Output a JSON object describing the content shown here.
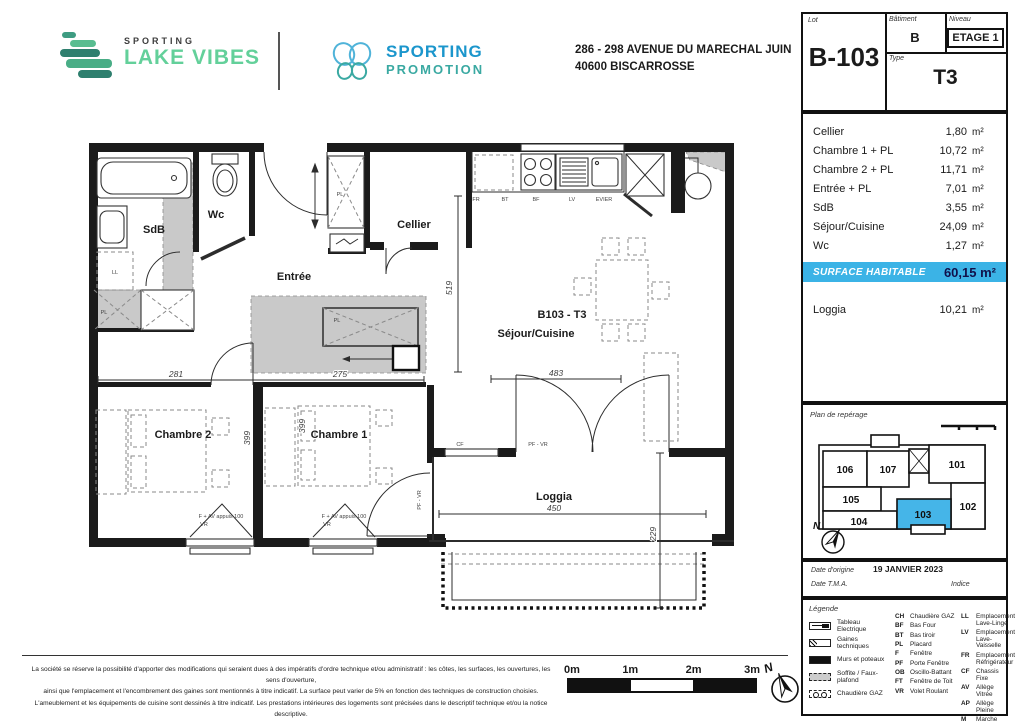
{
  "header": {
    "brand_small": "SPORTING",
    "brand_name": "LAKE VIBES",
    "promo_line1": "SPORTING",
    "promo_line2": "PROMOTION",
    "address_line1": "286 - 298 AVENUE DU MARECHAL JUIN",
    "address_line2": "40600 BISCARROSSE"
  },
  "lot": {
    "lot_label": "Lot",
    "lot_value": "B-103",
    "batiment_label": "Bâtiment",
    "batiment_value": "B",
    "niveau_label": "Niveau",
    "niveau_value": "ETAGE 1",
    "type_label": "Type",
    "type_value": "T3"
  },
  "areas": {
    "rows": [
      {
        "label": "Cellier",
        "value": "1,80",
        "unit": "m²"
      },
      {
        "label": "Chambre 1 + PL",
        "value": "10,72",
        "unit": "m²"
      },
      {
        "label": "Chambre 2 + PL",
        "value": "11,71",
        "unit": "m²"
      },
      {
        "label": "Entrée + PL",
        "value": "7,01",
        "unit": "m²"
      },
      {
        "label": "SdB",
        "value": "3,55",
        "unit": "m²"
      },
      {
        "label": "Séjour/Cuisine",
        "value": "24,09",
        "unit": "m²"
      },
      {
        "label": "Wc",
        "value": "1,27",
        "unit": "m²"
      }
    ],
    "total_label": "SURFACE HABITABLE",
    "total_value": "60,15 m²",
    "loggia": {
      "label": "Loggia",
      "value": "10,21",
      "unit": "m²"
    }
  },
  "reperage": {
    "title": "Plan de repérage",
    "north": "N",
    "units": [
      "106",
      "107",
      "101",
      "105",
      "102",
      "104",
      "103"
    ],
    "highlight_color": "#45b5e8"
  },
  "dates": {
    "origine_label": "Date d'origine",
    "origine_value": "19 JANVIER 2023",
    "tma_label": "Date T.M.A.",
    "indice_label": "Indice"
  },
  "legend": {
    "title": "Légende",
    "icons": [
      {
        "label": "Tableau Electrique"
      },
      {
        "label": "Gaines techniques"
      },
      {
        "label": "Murs et poteaux"
      },
      {
        "label": "Soffite / Faux-plafond"
      },
      {
        "label": "Chaudière GAZ"
      }
    ],
    "abbr1": [
      {
        "code": "CH",
        "label": "Chaudière GAZ"
      },
      {
        "code": "BF",
        "label": "Bas Four"
      },
      {
        "code": "BT",
        "label": "Bas tiroir"
      },
      {
        "code": "PL",
        "label": "Placard"
      },
      {
        "code": "F",
        "label": "Fenêtre"
      },
      {
        "code": "PF",
        "label": "Porte Fenêtre"
      },
      {
        "code": "OB",
        "label": "Oscillo-Battant"
      },
      {
        "code": "FT",
        "label": "Fenêtre de Toit"
      },
      {
        "code": "VR",
        "label": "Volet Roulant"
      }
    ],
    "abbr2": [
      {
        "code": "LL",
        "label": "Emplacement Lave-Linge"
      },
      {
        "code": "LV",
        "label": "Emplacement Lave-Vaisselle"
      },
      {
        "code": "FR",
        "label": "Emplacement Réfrigérateur"
      },
      {
        "code": "CF",
        "label": "Chassis Fixe"
      },
      {
        "code": "AV",
        "label": "Allège Vitrée"
      },
      {
        "code": "AP",
        "label": "Allège Pleine"
      },
      {
        "code": "M",
        "label": "Marche"
      }
    ]
  },
  "plan": {
    "labels": {
      "sdb": "SdB",
      "wc": "Wc",
      "entree": "Entrée",
      "cellier": "Cellier",
      "title": "B103 - T3",
      "subtitle": "Séjour/Cuisine",
      "chambre2": "Chambre 2",
      "chambre1": "Chambre 1",
      "loggia": "Loggia"
    },
    "dims": {
      "d281": "281",
      "d275": "275",
      "d399": "399",
      "d519": "519",
      "d483": "483",
      "d450": "450",
      "d229": "229"
    },
    "tags": {
      "ll": "LL",
      "pl": "PL",
      "fr": "FR",
      "bt": "BT",
      "bf": "BF",
      "lv": "LV",
      "evier": "EVIER",
      "cf": "CF",
      "pfvr": "PF - VR",
      "win": "F + AV appuis 100",
      "vr": "VR"
    }
  },
  "footer": {
    "disclaimer_lines": [
      "La société se réserve la possibilité d'apporter des modifications qui seraient dues à des impératifs d'ordre technique et/ou administratif : les côtes, les surfaces, les ouvertures, les sens d'ouverture,",
      "ainsi que l'emplacement et l'encombrement des gaines sont mentionnés à titre indicatif. La surface peut varier de 5% en fonction des techniques de construction choisies.",
      "L'ameublement et les équipements de cuisine sont dessinés à titre indicatif. Les prestations intérieures des logements sont précisées dans le descriptif technique et/ou la notice descriptive."
    ],
    "scale_labels": [
      "0m",
      "1m",
      "2m",
      "3m"
    ],
    "north": "N"
  }
}
